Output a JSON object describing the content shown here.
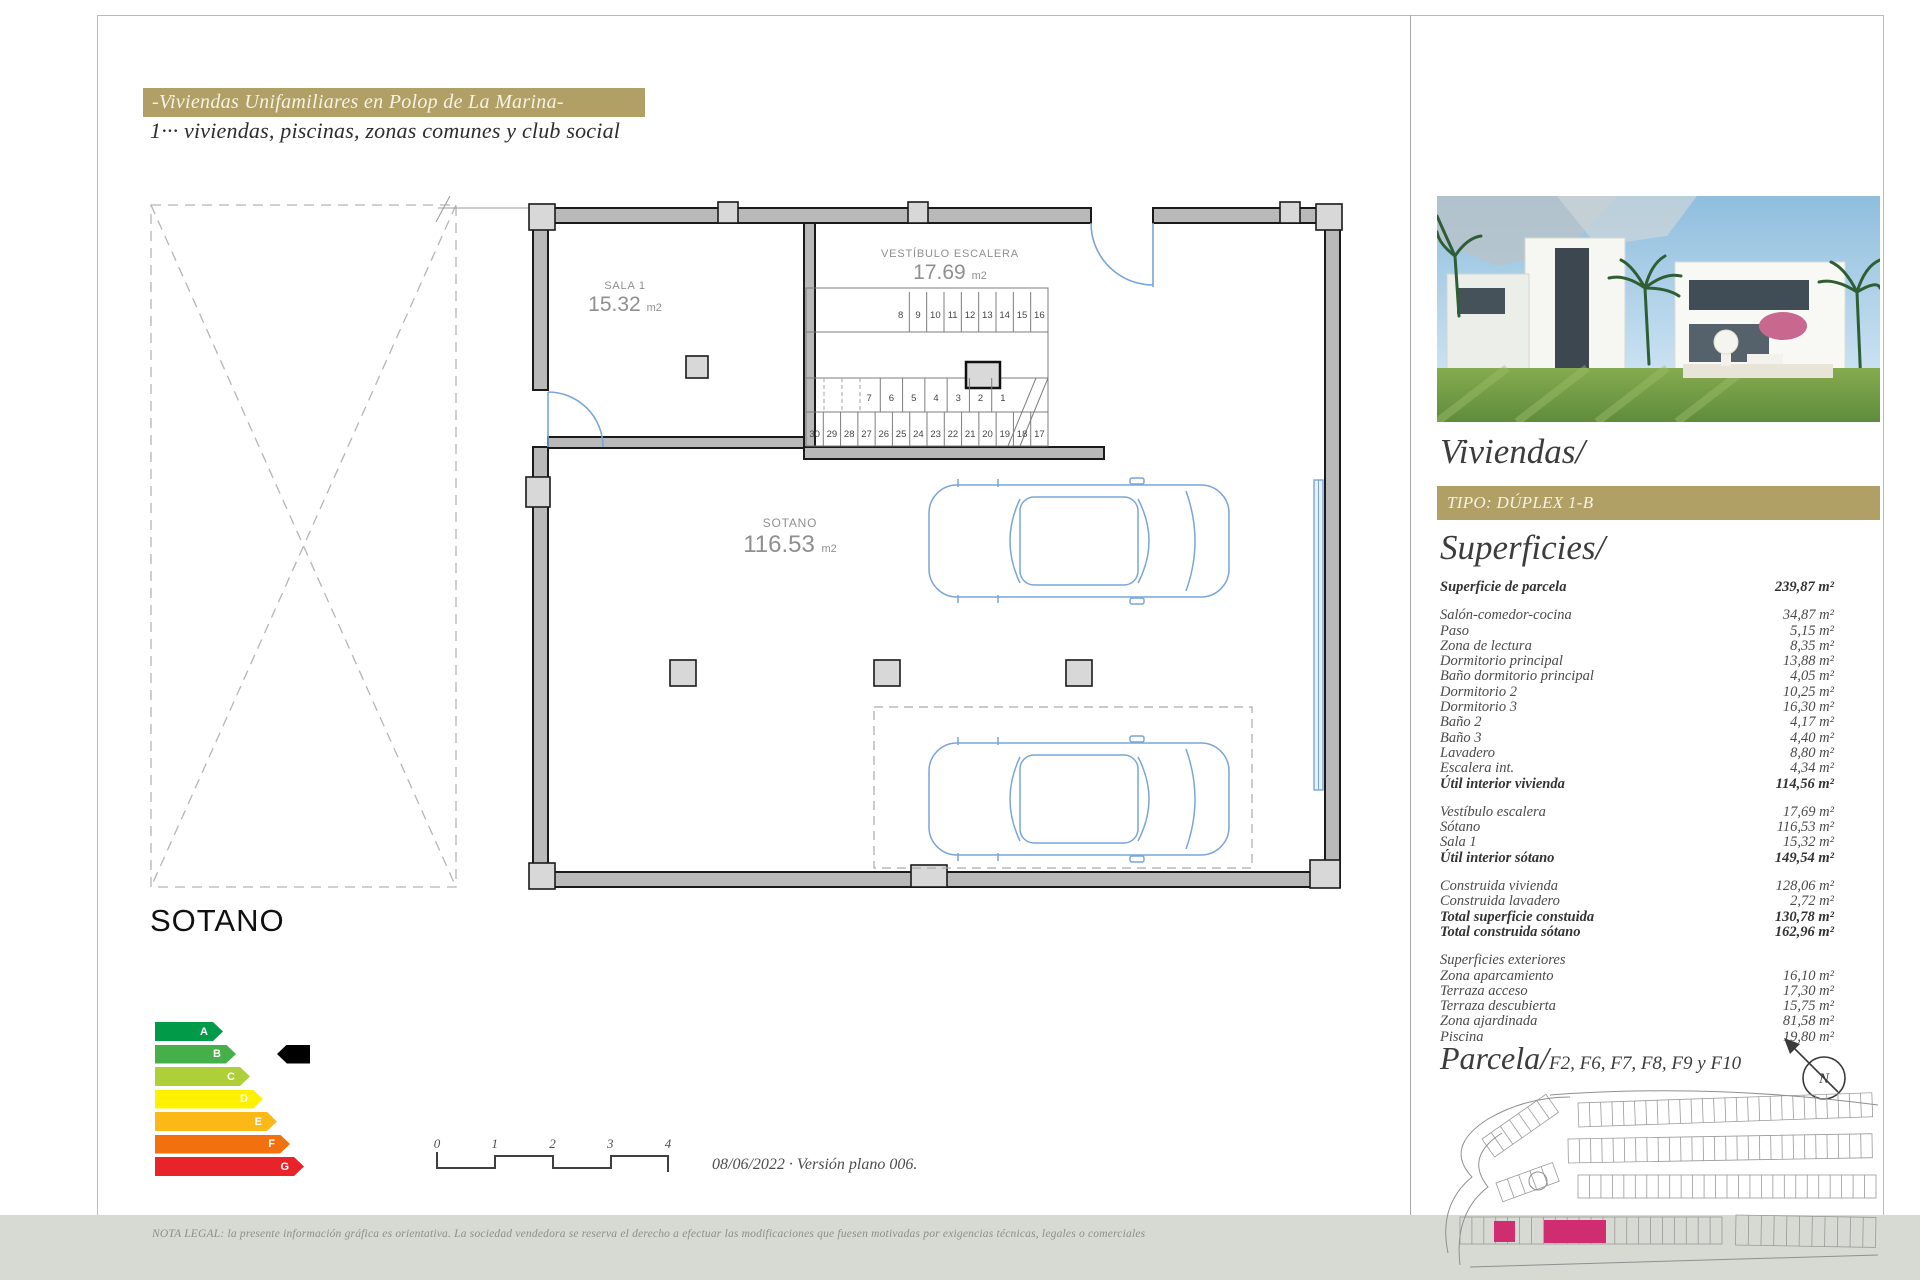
{
  "header": {
    "title": "-Viviendas Unifamiliares en Polop de La Marina-",
    "subtitle": "1··· viviendas, piscinas, zonas comunes y club social"
  },
  "plan": {
    "rooms": {
      "sala1": {
        "name": "SALA 1",
        "area": "15.32",
        "unit": "m2"
      },
      "vestibulo": {
        "name": "VESTÍBULO ESCALERA",
        "area": "17.69",
        "unit": "m2"
      },
      "sotano": {
        "name": "SOTANO",
        "area": "116.53",
        "unit": "m2"
      }
    },
    "stairs": {
      "top_row": [
        "8",
        "9",
        "10",
        "11",
        "12",
        "13",
        "14",
        "15",
        "16"
      ],
      "mid_row": [
        "7",
        "6",
        "5",
        "4",
        "3",
        "2",
        "1"
      ],
      "bottom_row": [
        "30",
        "29",
        "28",
        "27",
        "26",
        "25",
        "24",
        "23",
        "22",
        "21",
        "20",
        "19",
        "18",
        "17"
      ]
    }
  },
  "floor_title": "SOTANO",
  "energy": {
    "selected": "B",
    "bars": [
      {
        "letter": "A",
        "color": "#009a49"
      },
      {
        "letter": "B",
        "color": "#45b049"
      },
      {
        "letter": "C",
        "color": "#aecf38"
      },
      {
        "letter": "D",
        "color": "#fff100"
      },
      {
        "letter": "E",
        "color": "#fbb918"
      },
      {
        "letter": "F",
        "color": "#f2700e"
      },
      {
        "letter": "G",
        "color": "#e8232a"
      }
    ]
  },
  "scale_bar": {
    "labels": [
      "0",
      "1",
      "2",
      "3",
      "4"
    ]
  },
  "version_note": "08/06/2022 · Versión plano 006.",
  "footer": {
    "legal_note": "NOTA LEGAL: la presente información gráfica es orientativa. La sociedad vendedora se reserva el derecho a efectuar las modificaciones que fuesen motivadas por exigencias técnicas, legales o comerciales"
  },
  "sidebar": {
    "viviendas_title": "Viviendas/",
    "tipo_label": "TIPO: DÚPLEX 1-B",
    "superficies_title": "Superficies/",
    "superficies": {
      "groups": [
        {
          "rows": [
            {
              "label": "Superficie de parcela",
              "value": "239,87 m²",
              "bold": true
            }
          ]
        },
        {
          "rows": [
            {
              "label": "Salón-comedor-cocina",
              "value": "34,87 m²"
            },
            {
              "label": "Paso",
              "value": "5,15 m²"
            },
            {
              "label": "Zona de lectura",
              "value": "8,35 m²"
            },
            {
              "label": "Dormitorio principal",
              "value": "13,88 m²"
            },
            {
              "label": "Baño dormitorio principal",
              "value": "4,05 m²"
            },
            {
              "label": "Dormitorio 2",
              "value": "10,25 m²"
            },
            {
              "label": "Dormitorio 3",
              "value": "16,30 m²"
            },
            {
              "label": "Baño 2",
              "value": "4,17 m²"
            },
            {
              "label": "Baño 3",
              "value": "4,40 m²"
            },
            {
              "label": "Lavadero",
              "value": "8,80 m²"
            },
            {
              "label": "Escalera int.",
              "value": "4,34 m²"
            },
            {
              "label": "Útil interior vivienda",
              "value": "114,56 m²",
              "bold": true
            }
          ]
        },
        {
          "rows": [
            {
              "label": "Vestíbulo escalera",
              "value": "17,69 m²"
            },
            {
              "label": "Sótano",
              "value": "116,53 m²"
            },
            {
              "label": "Sala 1",
              "value": "15,32 m²"
            },
            {
              "label": "Útil interior sótano",
              "value": "149,54 m²",
              "bold": true
            }
          ]
        },
        {
          "rows": [
            {
              "label": "Construida vivienda",
              "value": "128,06 m²"
            },
            {
              "label": "Construida lavadero",
              "value": "2,72 m²"
            },
            {
              "label": "Total superficie constuida",
              "value": "130,78 m²",
              "bold": true
            },
            {
              "label": "Total construida sótano",
              "value": "162,96 m²",
              "bold": true
            }
          ]
        },
        {
          "rows": [
            {
              "label": "Superficies exteriores",
              "value": ""
            },
            {
              "label": "Zona aparcamiento",
              "value": "16,10 m²"
            },
            {
              "label": "Terraza acceso",
              "value": "17,30 m²"
            },
            {
              "label": "Terraza descubierta",
              "value": "15,75 m²"
            },
            {
              "label": "Zona ajardinada",
              "value": "81,58 m²"
            },
            {
              "label": "Piscina",
              "value": "19,80 m²"
            }
          ]
        }
      ]
    },
    "parcela": {
      "title": "Parcela/",
      "plots": "F2, F6, F7, F8, F9 y F10",
      "compass_letter": "N"
    }
  },
  "colors": {
    "gold": "#b1a066",
    "plan_blue": "#7aa5d8",
    "highlight_magenta": "#d02d70"
  }
}
